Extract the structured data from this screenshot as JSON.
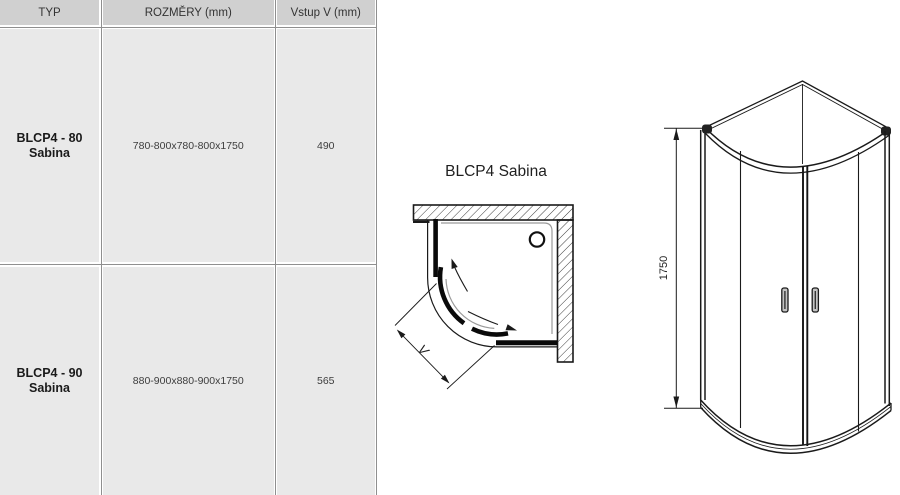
{
  "page": {
    "background": "#ffffff"
  },
  "table": {
    "columns": [
      "TYP",
      "ROZMĚRY (mm)",
      "Vstup V (mm)"
    ],
    "rows": [
      {
        "type_line1": "BLCP4 - 80",
        "type_line2": "Sabina",
        "dimensions": "780-800x780-800x1750",
        "entry": "490"
      },
      {
        "type_line1": "BLCP4 - 90",
        "type_line2": "Sabina",
        "dimensions": "880-900x880-900x1750",
        "entry": "565"
      }
    ],
    "colors": {
      "header_bg": "#d0d0d0",
      "cell_bg": "#e9e9e9",
      "grid_line": "#8f8f8f"
    }
  },
  "top_view": {
    "title": "BLCP4 Sabina",
    "entry_label": "V"
  },
  "front_view": {
    "height_label": "1750"
  }
}
